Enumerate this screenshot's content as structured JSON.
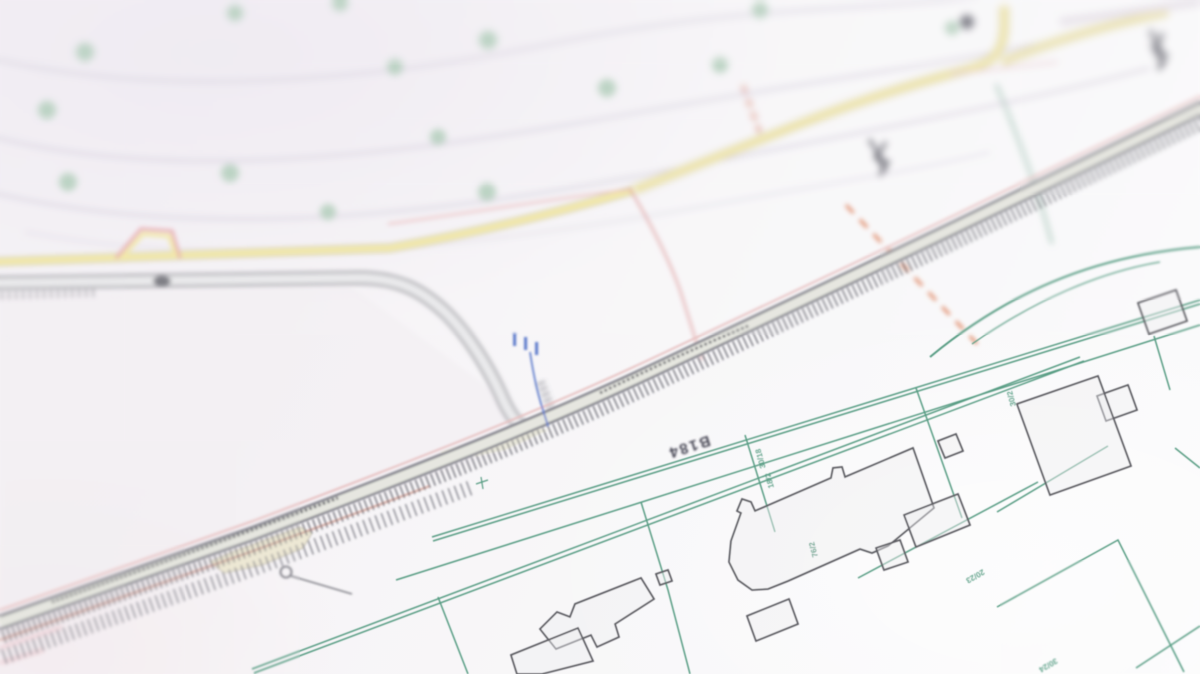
{
  "photo": {
    "description": "Angled close-up photograph of a paper cadastral map with shallow depth of field",
    "road_label": "B184",
    "parcel_labels": [
      "20/23",
      "30/18",
      "18/2",
      "76/2",
      "30/2",
      "30/24"
    ],
    "colors": {
      "parcel_line_green": "#3f8f72",
      "road_edge_dark": "#55555f",
      "minor_road_yellow": "#f1e69e",
      "boundary_red_dash": "#dd7a52",
      "boundary_pink": "#e5b8b8",
      "marker_blue": "#4f6fc8",
      "label_navy": "#2e2e3e",
      "tree_green": "#a7c8b2",
      "paper_white": "#f8f7f9"
    }
  }
}
